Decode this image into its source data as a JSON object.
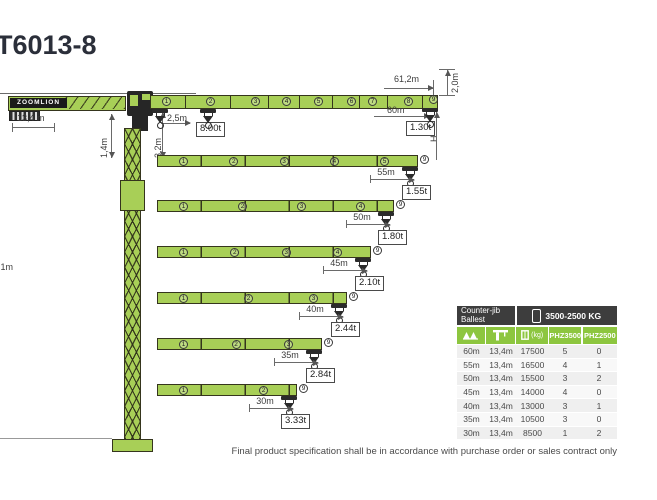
{
  "title": "T6013-8",
  "brand": "ZOOMLION",
  "note": "Final product specification shall be in accordance with purchase order or sales contract only",
  "diagram": {
    "counter_jib_dim": "13,4 m",
    "counter_jib_tail_height": "1,4m",
    "tower_head_height": "3,2m",
    "min_radius": "2,5m",
    "min_radius_load": "8.00t",
    "max_radius": "60m",
    "max_radius_load": "1.30t",
    "jib_total_length": "61,2m",
    "jib_tip_height": "2,0m",
    "hook_height_label": "H",
    "clipped_left_label": ",1m",
    "tip_section_marker": "9"
  },
  "jib_rows": [
    {
      "radius": "55m",
      "tip_load": "1.55t"
    },
    {
      "radius": "50m",
      "tip_load": "1.80t"
    },
    {
      "radius": "45m",
      "tip_load": "2.10t"
    },
    {
      "radius": "40m",
      "tip_load": "2.44t"
    },
    {
      "radius": "35m",
      "tip_load": "2.84t"
    },
    {
      "radius": "30m",
      "tip_load": "3.33t"
    }
  ],
  "table": {
    "header_left_line1": "Counter-jib",
    "header_left_line2": "Ballest",
    "header_right": "3500-2500 KG",
    "kg_label": "(kg)",
    "column_icons": [
      "jib-sections-icon",
      "tower-crane-icon",
      "ballast-kg-icon"
    ],
    "phz_labels": [
      "PHZ3500",
      "PHZ2500"
    ],
    "rows": [
      [
        "60m",
        "13,4m",
        "17500",
        "5",
        "0"
      ],
      [
        "55m",
        "13,4m",
        "16500",
        "4",
        "1"
      ],
      [
        "50m",
        "13,4m",
        "15500",
        "3",
        "2"
      ],
      [
        "45m",
        "13,4m",
        "14000",
        "4",
        "0"
      ],
      [
        "40m",
        "13,4m",
        "13000",
        "3",
        "1"
      ],
      [
        "35m",
        "13,4m",
        "10500",
        "3",
        "0"
      ],
      [
        "30m",
        "13,4m",
        "8500",
        "1",
        "2"
      ]
    ]
  },
  "colors": {
    "jib_green": "#a8cf57",
    "table_green": "#8dc63f",
    "header_dark": "#3d3d3d",
    "title_dark": "#2b2f3a"
  }
}
